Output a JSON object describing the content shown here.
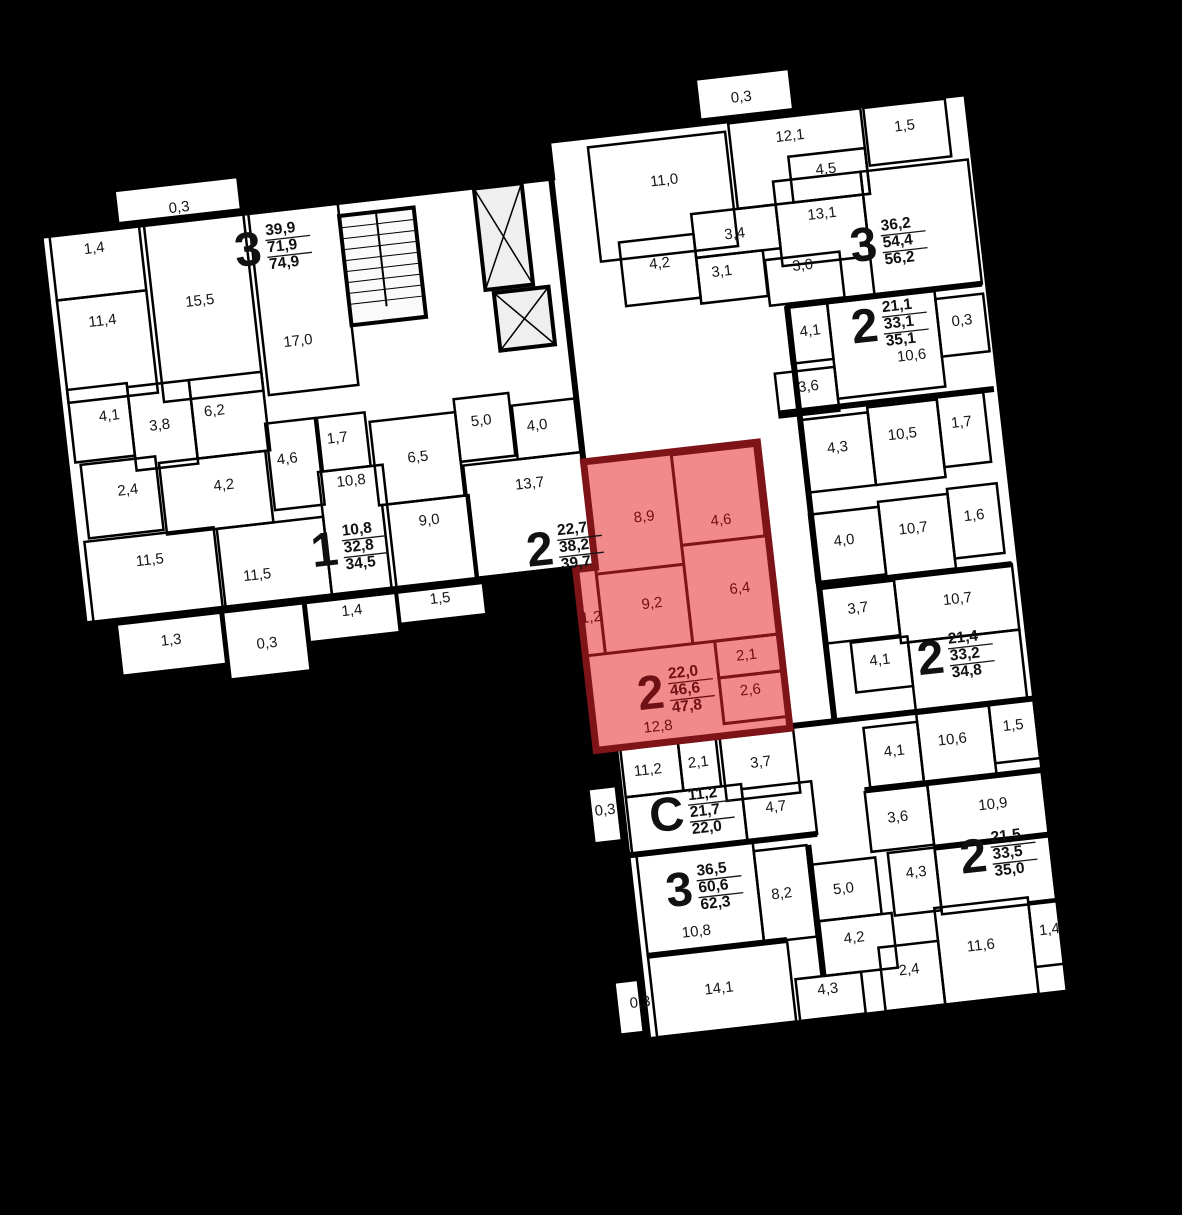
{
  "scene": {
    "type": "residential-floor-plan",
    "rotation_deg": -6.5,
    "highlighted_unit": {
      "rooms": "2",
      "areas": [
        "22,0",
        "46,6",
        "47,8"
      ]
    }
  },
  "colors": {
    "background": "#000000",
    "floor": "#ffffff",
    "walls": "#000000",
    "label": "#161616",
    "highlight_fill": "#f18a8a",
    "highlight_wall": "#7e1418",
    "highlight_text": "#6f1014"
  },
  "apartments": [
    {
      "n": "3",
      "v": [
        "39,9",
        "71,9",
        "74,9"
      ],
      "x": 304,
      "y": 212
    },
    {
      "n": "1",
      "v": [
        "10,8",
        "32,8",
        "34,5"
      ],
      "x": 346,
      "y": 519
    },
    {
      "n": "2",
      "v": [
        "22,7",
        "38,2",
        "39,7"
      ],
      "x": 560,
      "y": 543
    },
    {
      "n": "2",
      "v": [
        "22,0",
        "46,6",
        "47,8"
      ],
      "x": 654,
      "y": 698,
      "hl": 1
    },
    {
      "n": "3",
      "v": [
        "36,2",
        "54,4",
        "56,2"
      ],
      "x": 916,
      "y": 277
    },
    {
      "n": "2",
      "v": [
        "21,1",
        "33,1",
        "35,1"
      ],
      "x": 908,
      "y": 358
    },
    {
      "n": "2",
      "v": [
        "21,4",
        "33,2",
        "34,8"
      ],
      "x": 936,
      "y": 695
    },
    {
      "n": "С",
      "v": [
        "11,2",
        "21,7",
        "22,0"
      ],
      "x": 660,
      "y": 821
    },
    {
      "n": "3",
      "v": [
        "36,5",
        "60,6",
        "62,3"
      ],
      "x": 660,
      "y": 897
    },
    {
      "n": "2",
      "v": [
        "21,5",
        "33,5",
        "35,0"
      ],
      "x": 956,
      "y": 897
    }
  ],
  "room_labels": [
    {
      "t": "0,3",
      "x": 227,
      "y": 168
    },
    {
      "t": "1,4",
      "x": 138,
      "y": 199
    },
    {
      "t": "11,4",
      "x": 138,
      "y": 272
    },
    {
      "t": "15,5",
      "x": 237,
      "y": 263
    },
    {
      "t": "17,0",
      "x": 330,
      "y": 314
    },
    {
      "t": "4,1",
      "x": 134,
      "y": 367
    },
    {
      "t": "3,8",
      "x": 183,
      "y": 382
    },
    {
      "t": "6,2",
      "x": 239,
      "y": 374
    },
    {
      "t": "2,4",
      "x": 144,
      "y": 443
    },
    {
      "t": "4,2",
      "x": 240,
      "y": 449
    },
    {
      "t": "11,5",
      "x": 158,
      "y": 515
    },
    {
      "t": "11,5",
      "x": 263,
      "y": 542
    },
    {
      "t": "1,3",
      "x": 170,
      "y": 597
    },
    {
      "t": "0,3",
      "x": 265,
      "y": 611
    },
    {
      "t": "4,6",
      "x": 306,
      "y": 430
    },
    {
      "t": "1,7",
      "x": 358,
      "y": 415
    },
    {
      "t": "10,8",
      "x": 367,
      "y": 459
    },
    {
      "t": "1,4",
      "x": 353,
      "y": 588
    },
    {
      "t": "9,0",
      "x": 440,
      "y": 507
    },
    {
      "t": "6,5",
      "x": 436,
      "y": 443
    },
    {
      "t": "1,5",
      "x": 442,
      "y": 586
    },
    {
      "t": "5,0",
      "x": 503,
      "y": 414
    },
    {
      "t": "4,0",
      "x": 558,
      "y": 425
    },
    {
      "t": "13,7",
      "x": 544,
      "y": 482
    },
    {
      "t": "11,0",
      "x": 712,
      "y": 196
    },
    {
      "t": "3,4",
      "x": 776,
      "y": 257
    },
    {
      "t": "4,2",
      "x": 698,
      "y": 278
    },
    {
      "t": "3,1",
      "x": 759,
      "y": 293
    },
    {
      "t": "0,3",
      "x": 798,
      "y": 122
    },
    {
      "t": "12,1",
      "x": 842,
      "y": 166
    },
    {
      "t": "4,5",
      "x": 874,
      "y": 203
    },
    {
      "t": "1,5",
      "x": 957,
      "y": 169
    },
    {
      "t": "13,1",
      "x": 865,
      "y": 247
    },
    {
      "t": "3,0",
      "x": 840,
      "y": 296
    },
    {
      "t": "4,1",
      "x": 840,
      "y": 362
    },
    {
      "t": "10,6",
      "x": 938,
      "y": 398
    },
    {
      "t": "0,3",
      "x": 992,
      "y": 369
    },
    {
      "t": "3,6",
      "x": 832,
      "y": 417
    },
    {
      "t": "4,3",
      "x": 854,
      "y": 481
    },
    {
      "t": "10,5",
      "x": 920,
      "y": 475
    },
    {
      "t": "1,7",
      "x": 980,
      "y": 470
    },
    {
      "t": "4,0",
      "x": 850,
      "y": 574
    },
    {
      "t": "10,7",
      "x": 920,
      "y": 570
    },
    {
      "t": "1,6",
      "x": 982,
      "y": 564
    },
    {
      "t": "3,7",
      "x": 856,
      "y": 643
    },
    {
      "t": "10,7",
      "x": 956,
      "y": 645
    },
    {
      "t": "4,1",
      "x": 872,
      "y": 697
    },
    {
      "t": "4,1",
      "x": 876,
      "y": 789
    },
    {
      "t": "10,6",
      "x": 935,
      "y": 784
    },
    {
      "t": "1,5",
      "x": 997,
      "y": 777
    },
    {
      "t": "8,9",
      "x": 654,
      "y": 528,
      "hl": 1
    },
    {
      "t": "4,6",
      "x": 730,
      "y": 540,
      "hl": 1
    },
    {
      "t": "6,4",
      "x": 741,
      "y": 610,
      "hl": 1
    },
    {
      "t": "9,2",
      "x": 652,
      "y": 615,
      "hl": 1
    },
    {
      "t": "1,2",
      "x": 590,
      "y": 622,
      "hl": 1
    },
    {
      "t": "2,1",
      "x": 740,
      "y": 677,
      "hl": 1
    },
    {
      "t": "2,6",
      "x": 740,
      "y": 712,
      "hl": 1
    },
    {
      "t": "12,8",
      "x": 644,
      "y": 738,
      "hl": 1
    },
    {
      "t": "11,2",
      "x": 629,
      "y": 780
    },
    {
      "t": "2,1",
      "x": 680,
      "y": 778
    },
    {
      "t": "3,7",
      "x": 742,
      "y": 785
    },
    {
      "t": "4,7",
      "x": 752,
      "y": 831
    },
    {
      "t": "0,3",
      "x": 582,
      "y": 815
    },
    {
      "t": "3,6",
      "x": 872,
      "y": 855
    },
    {
      "t": "10,9",
      "x": 968,
      "y": 853
    },
    {
      "t": "4,3",
      "x": 884,
      "y": 912
    },
    {
      "t": "8,2",
      "x": 748,
      "y": 918
    },
    {
      "t": "5,0",
      "x": 810,
      "y": 920
    },
    {
      "t": "4,2",
      "x": 815,
      "y": 970
    },
    {
      "t": "4,3",
      "x": 783,
      "y": 1018
    },
    {
      "t": "2,4",
      "x": 866,
      "y": 1008
    },
    {
      "t": "14,1",
      "x": 675,
      "y": 1005
    },
    {
      "t": "10,8",
      "x": 659,
      "y": 946
    },
    {
      "t": "11,6",
      "x": 940,
      "y": 992
    },
    {
      "t": "1,4",
      "x": 1010,
      "y": 984
    },
    {
      "t": "0,3",
      "x": 595,
      "y": 1010
    }
  ]
}
